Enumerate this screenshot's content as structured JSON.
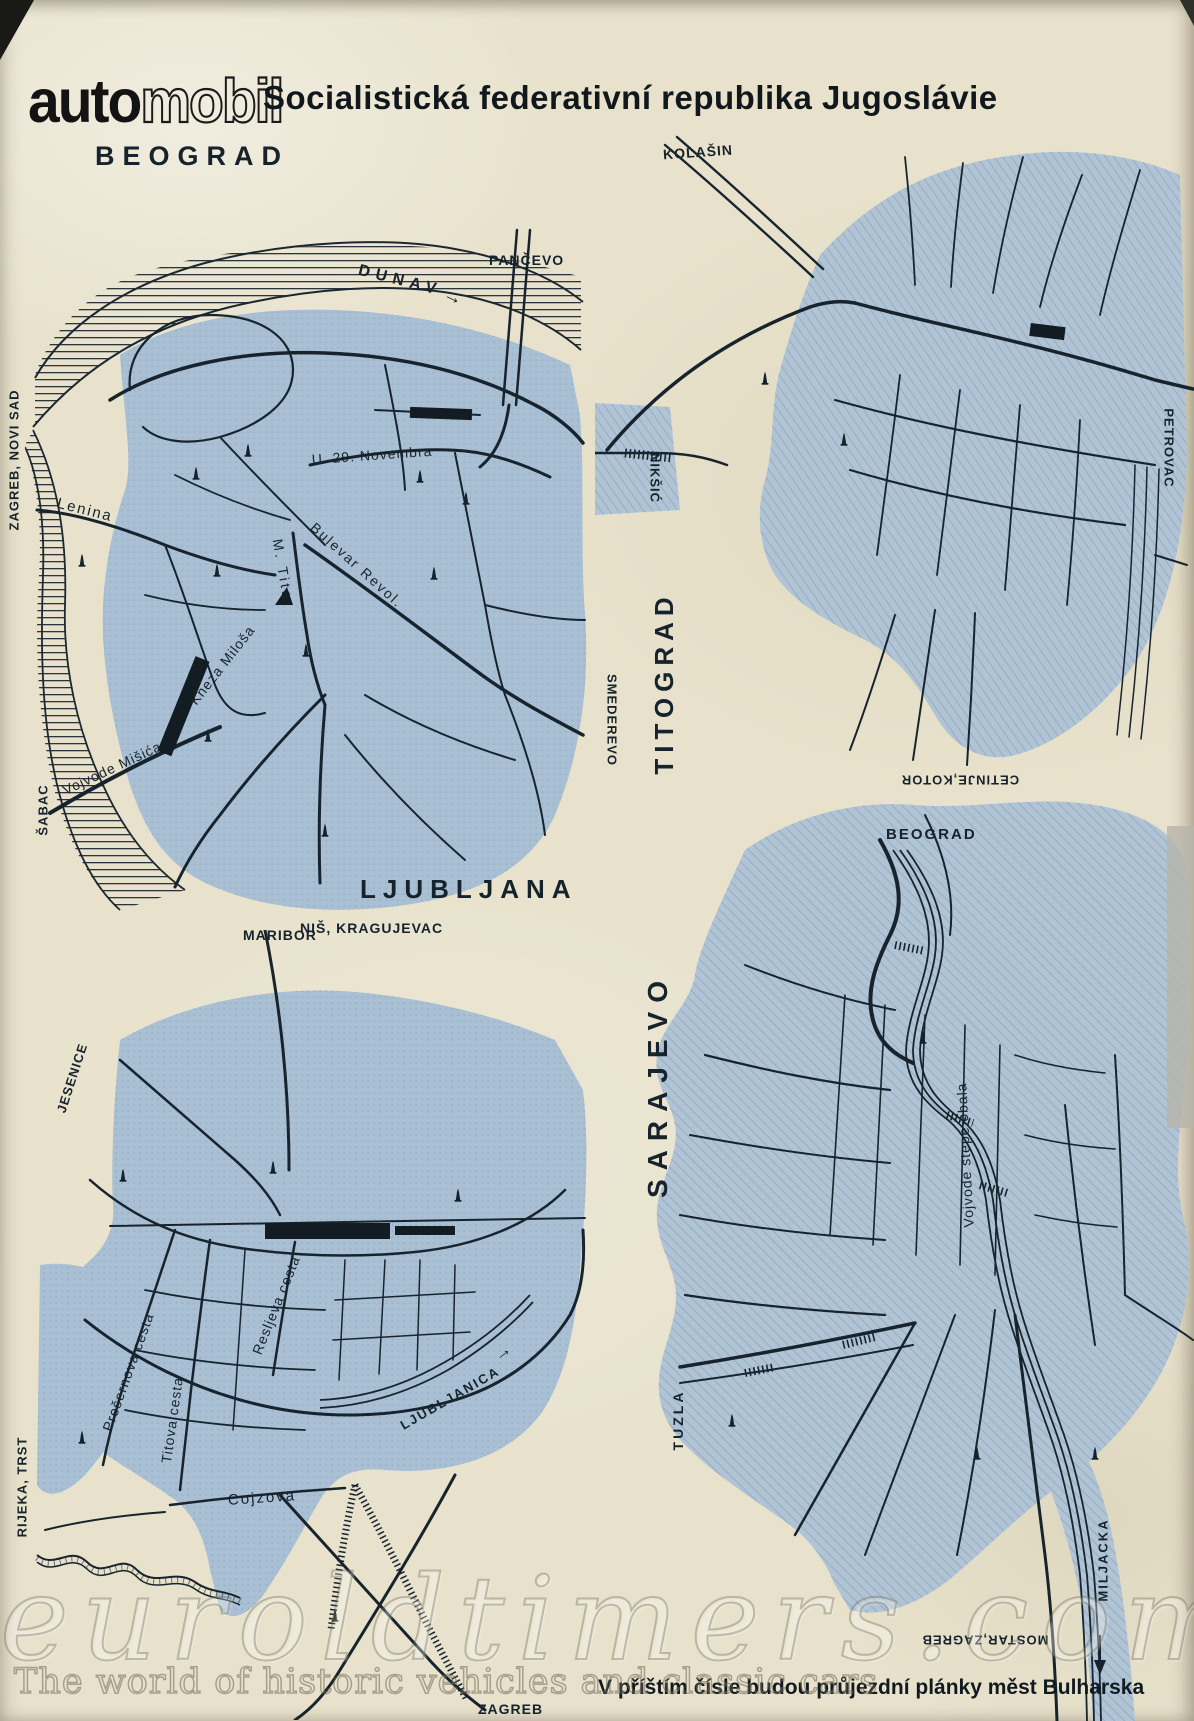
{
  "header": {
    "logo_auto": "auto",
    "logo_mobil": "mobil",
    "title": "Socialistická federativní republika Jugoslávie"
  },
  "colors": {
    "paper": "#e8e2cc",
    "map_fill_dotted": "#a9bfd3",
    "map_fill_hatched": "#b0c4d6",
    "ink": "#1b2830"
  },
  "icons": {
    "monument": "obelisk-marker",
    "station": "railway-station-bar",
    "bridge": "hatched-bridge",
    "flow_arrow": "→"
  },
  "beograd": {
    "title": "BEOGRAD",
    "river": "DUNAV",
    "flow_arrow": "→",
    "pancevo": "PANČEVO",
    "zagreb_novi_sad": "ZAGREB, NOVI SAD",
    "lenina": "Lenina",
    "novembra": "U. 29. Novembra",
    "m_tita": "M. Tita",
    "bulevar_revol": "Bulevar Revol.",
    "kneza_milosa": "Kneza Miloša",
    "vojvode_misica": "Vojvode Mišića",
    "sabac": "ŠABAC",
    "smederevo": "SMEDEREVO",
    "nis_kragujevac": "NIŠ, KRAGUJEVAC"
  },
  "titograd": {
    "title": "TITOGRAD",
    "kolasin": "KOLAŠIN",
    "niksic": "NIKŠIĆ",
    "petrovac": "PETROVAC",
    "cetinje_kotor": "CETINJE,KOTOR"
  },
  "ljubljana": {
    "title": "LJUBLJANA",
    "maribor": "MARIBOR",
    "jesenice": "JESENICE",
    "presernova": "Prešernova cesta",
    "titova": "Titova cesta",
    "resljeva": "Resljeva cesta",
    "ljubljanica": "LJUBLJANICA",
    "flow_arrow": "→",
    "cojzova": "Cojzova",
    "rijeka_trst": "RIJEKA, TRST",
    "zagreb": "ZAGREB"
  },
  "sarajevo": {
    "title": "SARAJEVO",
    "beograd": "BEOGRAD",
    "obala": "Vojvode stepe obala",
    "tuzla": "TUZLA",
    "miljacka": "MILJACKA",
    "mostar_zagreb": "MOSTAR,ZAGREB"
  },
  "footer": {
    "note": "V příštím čísle budou průjezdní plánky měst Bulharska"
  },
  "watermark": {
    "domain": "euroldtimers.com",
    "tagline": "The world of historic vehicles and classic cars"
  }
}
